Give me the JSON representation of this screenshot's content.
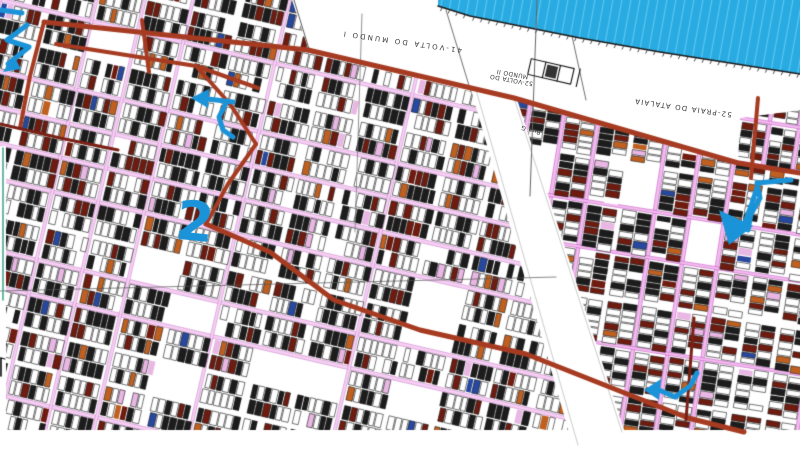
{
  "map": {
    "size": {
      "w": 800,
      "h": 449
    },
    "colors": {
      "water": "#29ABE2",
      "water_stripe": "#5BC6F0",
      "shoreline": "#1a1a1a",
      "road_red": "#A63B22",
      "road_maroon": "#7B2015",
      "street_pink": "#F6CFF4",
      "street_pink_edge": "#C985C9",
      "street_pink_right": "#F2BCEE",
      "street_edge_right": "#C44FC4",
      "parcel_black": "#1c1c1c",
      "parcel_maroon": "#6E1B10",
      "parcel_orange": "#C06020",
      "parcel_blue": "#27489E",
      "parcel_pink": "#E9B7E4",
      "annotation_blue": "#1B93D8",
      "ref_line": "#666666",
      "green_edge": "#2E9B84",
      "label_text": "#3a3a3a"
    },
    "water_polygon": [
      [
        438,
        0
      ],
      [
        800,
        0
      ],
      [
        800,
        74
      ],
      [
        660,
        52
      ],
      [
        580,
        38
      ],
      [
        470,
        16
      ],
      [
        438,
        6
      ]
    ],
    "shoreline": [
      [
        438,
        6
      ],
      [
        470,
        16
      ],
      [
        580,
        38
      ],
      [
        660,
        52
      ],
      [
        800,
        74
      ]
    ],
    "labels": [
      {
        "text": "41-VOLTA DO MUNDO I",
        "x": 402,
        "y": 41,
        "rot": 188,
        "size": 7,
        "spacing": 2.2
      },
      {
        "text": "52-VOLTA DO MUNDO II",
        "x": 512,
        "y": 76,
        "rot": 190,
        "size": 6,
        "spacing": 0.4,
        "width": 48
      },
      {
        "text": "52-PRAIA DO ATALAIA",
        "x": 683,
        "y": 107,
        "rot": 188,
        "size": 7,
        "spacing": 1.2
      },
      {
        "text": "Rua G",
        "x": 531,
        "y": 129,
        "rot": 196,
        "size": 6,
        "spacing": 0.5
      }
    ],
    "marker_2": {
      "text": "2",
      "x": 195,
      "y": 222,
      "rot": 6,
      "size": 54
    },
    "wedge_mask": [
      [
        292,
        0
      ],
      [
        800,
        0
      ],
      [
        800,
        110
      ],
      [
        740,
        118
      ],
      [
        738,
        163
      ],
      [
        514,
        98
      ],
      [
        308,
        48
      ]
    ],
    "corridor_mask": [
      [
        470,
        86
      ],
      [
        516,
        96
      ],
      [
        626,
        436
      ],
      [
        570,
        436
      ]
    ],
    "margins": {
      "bottom": [
        0,
        430,
        800,
        19
      ],
      "left": [
        0,
        146,
        6,
        290
      ]
    },
    "regions": [
      {
        "seed": 7,
        "angle": 13,
        "origin": [
          0,
          0
        ],
        "bw": 47,
        "bh": 35,
        "poly": [
          [
            0,
            0
          ],
          [
            297,
            0
          ],
          [
            310,
            50
          ],
          [
            480,
            94
          ],
          [
            578,
            449
          ],
          [
            0,
            449
          ]
        ],
        "urange": [
          -80,
          720
        ],
        "vrange": [
          -170,
          470
        ],
        "dark": 0.3,
        "maroon": 0.12,
        "orange": 0.045,
        "blue": 0.018,
        "pink": 0.03,
        "street_p": 0.55,
        "empty_p": 0.07,
        "street_fill": "#F6CFF4",
        "street_edge": "#C985C9"
      },
      {
        "seed": 12,
        "angle": 99,
        "origin": [
          600,
          110
        ],
        "bw": 46,
        "bh": 35,
        "poly": [
          [
            512,
            98
          ],
          [
            800,
            176
          ],
          [
            800,
            432
          ],
          [
            620,
            432
          ]
        ],
        "urange": [
          -60,
          340
        ],
        "vrange": [
          -260,
          100
        ],
        "dark": 0.3,
        "maroon": 0.18,
        "orange": 0.05,
        "blue": 0.012,
        "pink": 0.035,
        "street_p": 0.6,
        "empty_p": 0.05,
        "street_fill": "#F2BCEE",
        "street_edge": "#C44FC4"
      },
      {
        "seed": 3,
        "angle": 99,
        "origin": [
          740,
          118
        ],
        "bw": 44,
        "bh": 30,
        "poly": [
          [
            738,
            118
          ],
          [
            800,
            110
          ],
          [
            800,
            172
          ],
          [
            738,
            163
          ]
        ],
        "urange": [
          -20,
          80
        ],
        "vrange": [
          -75,
          12
        ],
        "dark": 0.28,
        "maroon": 0.16,
        "orange": 0.05,
        "blue": 0.012,
        "pink": 0.03,
        "street_p": 0.55,
        "empty_p": 0.05,
        "street_fill": "#F2BCEE",
        "street_edge": "#C44FC4"
      }
    ],
    "roads_red": [
      {
        "pts": [
          [
            44,
            22
          ],
          [
            308,
            50
          ],
          [
            514,
            98
          ],
          [
            738,
            163
          ],
          [
            800,
            173
          ]
        ],
        "w": 5
      },
      {
        "pts": [
          [
            44,
            22
          ],
          [
            30,
            76
          ],
          [
            20,
            128
          ]
        ],
        "w": 4
      },
      {
        "pts": [
          [
            56,
            44
          ],
          [
            196,
            66
          ],
          [
            258,
            88
          ]
        ],
        "w": 4
      },
      {
        "pts": [
          [
            196,
            66
          ],
          [
            230,
            104
          ],
          [
            256,
            144
          ]
        ],
        "w": 4
      },
      {
        "pts": [
          [
            256,
            144
          ],
          [
            228,
            184
          ],
          [
            206,
            224
          ]
        ],
        "w": 4
      },
      {
        "pts": [
          [
            206,
            224
          ],
          [
            270,
            252
          ],
          [
            334,
            300
          ],
          [
            420,
            330
          ],
          [
            526,
            354
          ],
          [
            688,
            418
          ],
          [
            744,
            432
          ]
        ],
        "w": 5
      },
      {
        "pts": [
          [
            142,
            20
          ],
          [
            149,
            72
          ]
        ],
        "w": 4
      },
      {
        "pts": [
          [
            758,
            98
          ],
          [
            751,
            178
          ]
        ],
        "w": 4
      }
    ],
    "roads_maroon": [
      {
        "pts": [
          [
            0,
            124
          ],
          [
            60,
            138
          ],
          [
            118,
            150
          ]
        ],
        "w": 3
      },
      {
        "pts": [
          [
            694,
            318
          ],
          [
            686,
            420
          ]
        ],
        "w": 3
      }
    ],
    "ref_lines": [
      {
        "pts": [
          [
            0,
            291
          ],
          [
            556,
            277
          ]
        ],
        "w": 0.7,
        "c": "#555555"
      },
      {
        "pts": [
          [
            362,
            14
          ],
          [
            355,
            232
          ]
        ],
        "w": 0.8,
        "c": "#777777"
      },
      {
        "pts": [
          [
            537,
            0
          ],
          [
            530,
            196
          ]
        ],
        "w": 1,
        "c": "#666666"
      },
      {
        "pts": [
          [
            294,
            0
          ],
          [
            309,
            49
          ]
        ],
        "w": 0.8,
        "c": "#333333"
      },
      {
        "pts": [
          [
            446,
            10
          ],
          [
            471,
            92
          ]
        ],
        "w": 0.7,
        "c": "#333333"
      },
      {
        "pts": [
          [
            572,
            36
          ],
          [
            586,
            100
          ]
        ],
        "w": 0.7,
        "c": "#333333"
      },
      {
        "pts": [
          [
            476,
            90
          ],
          [
            578,
            445
          ]
        ],
        "w": 0.5,
        "c": "#999999"
      },
      {
        "pts": [
          [
            514,
            98
          ],
          [
            622,
            432
          ]
        ],
        "w": 0.5,
        "c": "#999999"
      },
      {
        "pts": [
          [
            1,
            358
          ],
          [
            1,
            376
          ]
        ],
        "w": 1.6,
        "c": "#111111"
      },
      {
        "pts": [
          [
            1,
            358
          ],
          [
            5,
            359
          ]
        ],
        "w": 1.2,
        "c": "#111111"
      }
    ],
    "green_line": {
      "pts": [
        [
          3,
          148
        ],
        [
          3,
          300
        ]
      ],
      "w": 1.4
    },
    "building_symbol": {
      "x": 549,
      "y": 71,
      "rot": 193
    },
    "arrows": [
      {
        "name": "top-left-zigzag-arrow",
        "strokes": [
          [
            [
              1,
              10
            ],
            [
              22,
              13
            ]
          ],
          [
            [
              27,
              25
            ],
            [
              7,
              40
            ],
            [
              29,
              47
            ],
            [
              8,
              64
            ]
          ]
        ],
        "head": [
          [
            3,
            72
          ],
          [
            14,
            56
          ],
          [
            21,
            69
          ]
        ],
        "w": 5
      },
      {
        "name": "upper-left-curl-arrow",
        "strokes": [
          [
            [
              233,
              102
            ],
            [
              208,
              99
            ]
          ],
          [
            [
              226,
              103
            ],
            [
              219,
              117
            ],
            [
              223,
              130
            ],
            [
              233,
              137
            ]
          ]
        ],
        "head": [
          [
            191,
            98
          ],
          [
            209,
            89
          ],
          [
            208,
            108
          ]
        ],
        "w": 5
      },
      {
        "name": "big-right-down-arrow",
        "strokes": [
          [
            [
              791,
              180
            ],
            [
              757,
              183
            ],
            [
              760,
              198
            ],
            [
              751,
              214
            ],
            [
              748,
              230
            ]
          ],
          [
            [
              757,
              188
            ],
            [
              751,
              206
            ],
            [
              745,
              222
            ]
          ]
        ],
        "head": [
          [
            729,
            245
          ],
          [
            719,
            210
          ],
          [
            753,
            226
          ]
        ],
        "w": 5
      },
      {
        "name": "bottom-left-pointing-arrow",
        "strokes": [
          [
            [
              697,
              373
            ],
            [
              690,
              386
            ],
            [
              675,
              397
            ],
            [
              659,
              390
            ]
          ]
        ],
        "head": [
          [
            644,
            390
          ],
          [
            661,
            379
          ],
          [
            659,
            400
          ]
        ],
        "w": 5
      }
    ]
  }
}
